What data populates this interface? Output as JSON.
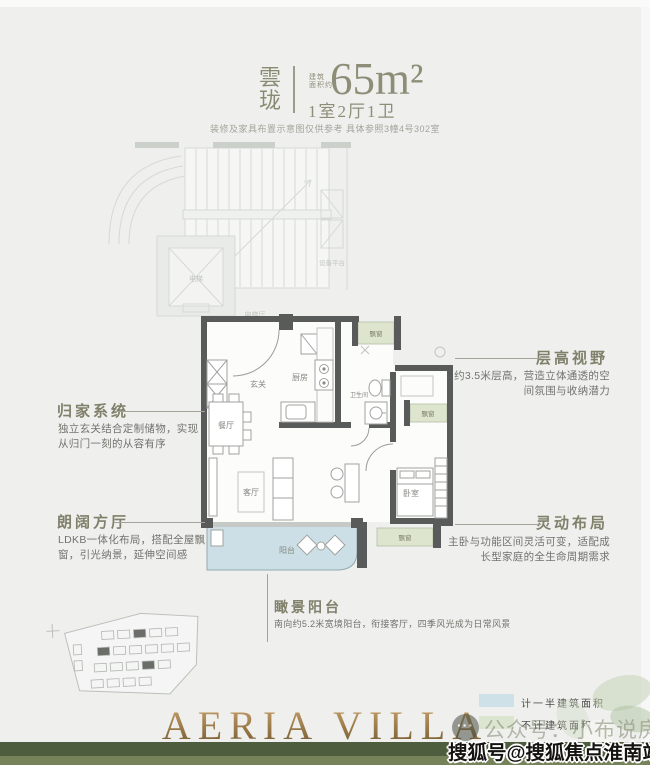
{
  "header": {
    "project_name_char1": "雲",
    "project_name_char2": "珑",
    "area_prefix_top": "建筑",
    "area_prefix_bottom": "面积约",
    "area_value": "65m²",
    "unit_layout": "1室2厅1卫",
    "disclaimer": "装修及家具布置示意图仅供参考  具体参照3幢4号302室"
  },
  "annotations": {
    "home_system": {
      "title": "归家系统",
      "line1": "独立玄关结合定制储物，实现",
      "line2": "从归门一刻的从容有序"
    },
    "living_hall": {
      "title": "朗阔方厅",
      "line1": "LDKB一体化布局，搭配全屋飘",
      "line2": "窗，引光纳景，延伸空间感"
    },
    "ceiling_view": {
      "title": "层高视野",
      "line1": "约3.5米层高，营造立体通透的空",
      "line2": "间氛围与收纳潜力"
    },
    "flexible_layout": {
      "title": "灵动布局",
      "line1": "主卧与功能区间灵活可变，适配成",
      "line2": "长型家庭的全生命周期需求"
    },
    "view_balcony": {
      "title": "瞰景阳台",
      "line1": "南向约5.2米宽境阳台，衔接客厅，四季风光成为日常风景"
    }
  },
  "plan": {
    "labels": {
      "entry": "玄关",
      "kitchen": "厨房",
      "dining": "餐厅",
      "bathroom": "卫生间",
      "living": "客厅",
      "balcony": "阳台",
      "bedroom": "卧室",
      "bay_window": "飘窗",
      "elevator": "电梯",
      "elevator_hall": "电梯厅",
      "equipment": "设备平台"
    }
  },
  "legend": {
    "half_area": {
      "label": "计一半建筑面积",
      "color": "#cfe1e8"
    },
    "excluded_area": {
      "label": "不计建筑面积",
      "color": "#dce5cf"
    }
  },
  "footer": {
    "brand": "AERIA VILLA",
    "wechat_account": "公众号：小布说房",
    "logo_dots": "···",
    "watermark": "搜狐号@搜狐焦点淮南站"
  },
  "colors": {
    "accent_olive": "#8e8e78",
    "wall": "#595b5b",
    "balcony_fill": "#ccdfe6",
    "bay_fill": "#dde5cf",
    "footer_bar": "#4e5d3d"
  }
}
